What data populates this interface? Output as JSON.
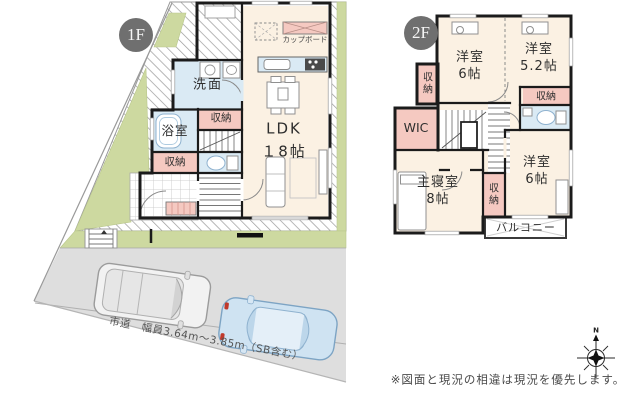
{
  "palette": {
    "room_cream": "#fbf1e3",
    "storage_pink": "#f5c9c1",
    "wet_blue": "#daeaf4",
    "site_green": "#cdd9a0",
    "road_gray": "#dedede",
    "wall": "#1b1b1b",
    "badge_gray": "#6f6f6f",
    "car_blue": "#cfe3f2"
  },
  "floor1": {
    "badge": "1F",
    "rooms": {
      "ldk": "LDK\n１8帖",
      "senmen": "洗面",
      "bath": "浴室",
      "storage_a": "収納",
      "storage_b": "収納",
      "cupboard": "カップボード"
    }
  },
  "floor2": {
    "badge": "2F",
    "rooms": {
      "bed_top_left": "洋室\n6帖",
      "bed_top_right": "洋室\n5.2帖",
      "bed_bottom_right": "洋室\n6帖",
      "master": "主寝室\n8帖",
      "wic": "WIC",
      "storage_left": "収\n納",
      "storage_right": "収納",
      "storage_bottom": "収\n納",
      "balcony": "バルコニー"
    }
  },
  "site": {
    "road_label": "市道　幅員3.64m〜3.85m（SB含む）"
  },
  "compass": {
    "north": "N"
  },
  "disclaimer": "※図面と現況の相違は現況を優先します。"
}
